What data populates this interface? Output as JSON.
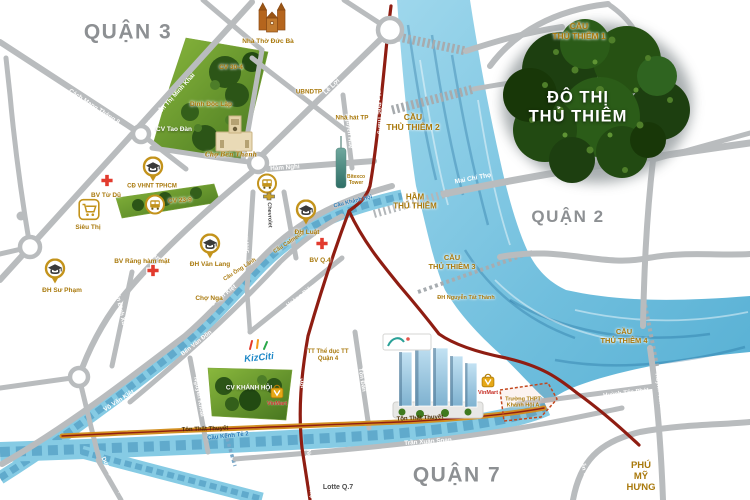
{
  "colors": {
    "road": "#b9bcbe",
    "gold": "#a9790c",
    "blue": "#2577b5",
    "district": "#8d9093",
    "water": "#86cbe4",
    "red-route": "#8f1d12",
    "orange-route": "#d29022",
    "park-green": "#46751f",
    "tree-green": "#224a12",
    "cross-red": "#e23b2e",
    "marker-gold": "#c3931b"
  },
  "map": {
    "districts": [
      {
        "name": "district-label-quan-3",
        "text": "QUẬN 3",
        "x": 128,
        "y": 33,
        "size": 21,
        "cls": "gray"
      },
      {
        "name": "district-label-quan-2",
        "text": "QUẬN 2",
        "x": 568,
        "y": 217,
        "size": 17,
        "cls": "gray"
      },
      {
        "name": "district-label-quan-7",
        "text": "QUẬN 7",
        "x": 457,
        "y": 476,
        "size": 21,
        "cls": "gray"
      },
      {
        "name": "area-label-phu-my-hung",
        "text": "PHÚ\nMỸ\nHƯNG",
        "x": 641,
        "y": 477,
        "size": 9.5,
        "cls": "gold"
      },
      {
        "name": "area-label-do-thi-thu-thiem",
        "text": "ĐÔ THỊ\nTHỦ THIÊM",
        "x": 578,
        "y": 108,
        "size": 16.5,
        "cls": "bigwhite"
      }
    ],
    "bridges": [
      {
        "name": "bridge-label-thu-thiem-1",
        "text": "CẦU\nTHỦ THIÊM 1",
        "x": 579,
        "y": 31,
        "size": 8.5,
        "cls": "gold"
      },
      {
        "name": "bridge-label-thu-thiem-2",
        "text": "CẦU\nTHỦ THIÊM 2",
        "x": 413,
        "y": 122,
        "size": 8.5,
        "cls": "gold"
      },
      {
        "name": "tunnel-label-thu-thiem",
        "text": "HẦM\nTHỦ THIÊM",
        "x": 415,
        "y": 202,
        "size": 8,
        "cls": "gold"
      },
      {
        "name": "bridge-label-thu-thiem-3",
        "text": "CẦU\nTHỦ THIÊM 3",
        "x": 452,
        "y": 263,
        "size": 7.5,
        "cls": "gold"
      },
      {
        "name": "bridge-label-thu-thiem-4",
        "text": "CẦU\nTHỦ THIÊM 4",
        "x": 624,
        "y": 337,
        "size": 7.5,
        "cls": "gold"
      },
      {
        "name": "bridge-label-ong-lanh",
        "text": "Cầu Ông Lãnh",
        "x": 240,
        "y": 270,
        "size": 5.5,
        "rot": -33,
        "cls": "gold"
      },
      {
        "name": "bridge-label-calmette",
        "text": "Cầu Calmette",
        "x": 289,
        "y": 243,
        "size": 5.5,
        "rot": -33,
        "cls": "gold"
      },
      {
        "name": "bridge-label-khanh-hoi",
        "text": "Cầu Khánh Hội",
        "x": 353,
        "y": 202,
        "size": 5.5,
        "rot": -14,
        "cls": "blue"
      },
      {
        "name": "bridge-label-kenh-te-2",
        "text": "Cầu Kênh Tẻ 2",
        "x": 228,
        "y": 437,
        "size": 6,
        "rot": -6,
        "cls": "blue"
      }
    ],
    "roads": [
      {
        "name": "road-label-cach-mang-thang-8",
        "text": "Cách Mạng Tháng 8",
        "x": 94,
        "y": 107,
        "size": 6.3,
        "rot": 33,
        "cls": "onroad"
      },
      {
        "name": "road-label-nguyen-thi-minh-khai-1",
        "text": "Nguyễn Thị Minh Khai",
        "x": 60,
        "y": 204,
        "size": 6.3,
        "rot": -48,
        "cls": "onroad"
      },
      {
        "name": "road-label-nguyen-thi-minh-khai-2",
        "text": "Nguyễn Thị Minh Khai",
        "x": 172,
        "y": 99,
        "size": 6.3,
        "rot": -48,
        "cls": "onroad"
      },
      {
        "name": "road-label-le-loi",
        "text": "Lê Lợi",
        "x": 332,
        "y": 87,
        "size": 6.5,
        "rot": -44,
        "cls": "onroad"
      },
      {
        "name": "road-label-ham-nghi",
        "text": "Hàm Nghi",
        "x": 285,
        "y": 168,
        "size": 6.3,
        "rot": -4,
        "cls": "onroad"
      },
      {
        "name": "road-label-nguyen-hue",
        "text": "Nguyễn Huệ",
        "x": 348,
        "y": 131,
        "size": 6,
        "rot": 84,
        "cls": "onroad"
      },
      {
        "name": "road-label-ton-duc-thang",
        "text": "Tôn Đức Thắng",
        "x": 378,
        "y": 112,
        "size": 6,
        "rot": 87,
        "cls": "onroad"
      },
      {
        "name": "road-label-mai-chi-tho",
        "text": "Mai Chí Thọ",
        "x": 473,
        "y": 179,
        "size": 6.5,
        "rot": -11,
        "cls": "onroad"
      },
      {
        "name": "road-label-nguyen-thai-hoc",
        "text": "Nguyễn Thái Học",
        "x": 243,
        "y": 229,
        "size": 6,
        "rot": 82,
        "cls": "onroad"
      },
      {
        "name": "road-label-tran-hung-dao",
        "text": "Trần Hưng Đạo",
        "x": 157,
        "y": 258,
        "size": 6.3,
        "rot": 40,
        "cls": "onroad"
      },
      {
        "name": "road-label-tran-dinh-xu",
        "text": "Trần Đình Xu",
        "x": 119,
        "y": 307,
        "size": 6,
        "rot": 78,
        "cls": "onroad"
      },
      {
        "name": "road-label-nguyen-van-cu",
        "text": "Nguyễn Văn Cừ",
        "x": 56,
        "y": 316,
        "size": 6,
        "rot": 64,
        "cls": "onroad"
      },
      {
        "name": "road-label-vo-van-kiet-1",
        "text": "Võ Văn Kiệt",
        "x": 222,
        "y": 297,
        "size": 6.3,
        "rot": -38,
        "cls": "onroad"
      },
      {
        "name": "road-label-vo-van-kiet-2",
        "text": "Võ Văn Kiệt",
        "x": 119,
        "y": 401,
        "size": 6.3,
        "rot": -33,
        "cls": "onroad"
      },
      {
        "name": "road-label-ben-van-don",
        "text": "Bến Vân Đồn",
        "x": 197,
        "y": 344,
        "size": 6,
        "rot": -38,
        "cls": "onroad"
      },
      {
        "name": "road-label-nguyen-khoai",
        "text": "Nguyễn Khoái",
        "x": 198,
        "y": 397,
        "size": 6,
        "rot": 80,
        "cls": "onroad"
      },
      {
        "name": "road-label-khanh-hoi",
        "text": "Khánh Hội",
        "x": 297,
        "y": 374,
        "size": 6,
        "rot": 72,
        "cls": "onroad"
      },
      {
        "name": "road-label-ton-dan",
        "text": "Tôn Đản",
        "x": 361,
        "y": 380,
        "size": 6,
        "rot": 81,
        "cls": "onroad"
      },
      {
        "name": "road-label-hoang-dieu",
        "text": "Hoàng Diệu",
        "x": 301,
        "y": 297,
        "size": 6,
        "rot": -37,
        "cls": "onroad"
      },
      {
        "name": "road-label-ton-that-thuyet-1",
        "text": "Tôn Thất Thuyết",
        "x": 205,
        "y": 430,
        "size": 6,
        "rot": -2,
        "cls": "dark"
      },
      {
        "name": "road-label-ton-that-thuyet-2",
        "text": "Tôn Thất Thuyết",
        "x": 420,
        "y": 419,
        "size": 6,
        "rot": -3,
        "cls": "dark"
      },
      {
        "name": "road-label-tran-xuan-soan",
        "text": "Trần Xuân Soạn",
        "x": 428,
        "y": 442,
        "size": 6.3,
        "rot": -4,
        "cls": "onroad"
      },
      {
        "name": "road-label-duong-ba-trac",
        "text": "Dương Bá Trạc",
        "x": 112,
        "y": 477,
        "size": 6,
        "rot": 62,
        "cls": "onroad"
      },
      {
        "name": "road-label-huynh-tan-phat-1",
        "text": "Huỳnh Tấn Phát",
        "x": 626,
        "y": 394,
        "size": 6,
        "rot": -7,
        "cls": "onroad"
      },
      {
        "name": "road-label-huynh-tan-phat-2",
        "text": "Huỳnh Tấn Phát",
        "x": 659,
        "y": 396,
        "size": 6,
        "rot": 82,
        "cls": "onroad"
      },
      {
        "name": "road-label-nguyen-van-linh",
        "text": "Nguyễn Văn Linh",
        "x": 584,
        "y": 473,
        "size": 6,
        "rot": 72,
        "cls": "onroad"
      },
      {
        "name": "road-label-nguyen-huu-tho",
        "text": "Nguyễn Hữu Thọ",
        "x": 309,
        "y": 474,
        "size": 6,
        "rot": 86,
        "cls": "onroad"
      }
    ],
    "pois": [
      {
        "name": "poi-label-cv-30-4",
        "text": "CV 30-4",
        "x": 231,
        "y": 68,
        "size": 6.5,
        "cls": "gold"
      },
      {
        "name": "poi-label-dinh-doc-lap",
        "text": "Dinh Độc Lập",
        "x": 211,
        "y": 105,
        "size": 6.5,
        "cls": "gold"
      },
      {
        "name": "poi-label-cv-tao-dan",
        "text": "CV Tao Đàn",
        "x": 174,
        "y": 130,
        "size": 6.5,
        "cls": "white"
      },
      {
        "name": "poi-label-nha-tho-duc-ba",
        "text": "Nhà Thờ Đức Bà",
        "x": 268,
        "y": 42,
        "size": 6.5,
        "cls": "gold"
      },
      {
        "name": "poi-label-ubndtp",
        "text": "UBNDTP",
        "x": 309,
        "y": 92,
        "size": 6.3,
        "cls": "gold"
      },
      {
        "name": "poi-label-nha-hat-tp",
        "text": "Nhà hát TP",
        "x": 352,
        "y": 118,
        "size": 6.3,
        "cls": "gold"
      },
      {
        "name": "poi-label-bitexco",
        "text": "Bitexco\nTower",
        "x": 356,
        "y": 181,
        "size": 5,
        "cls": "gold"
      },
      {
        "name": "poi-label-cho-ben-thanh",
        "text": "Chợ Bến Thành",
        "x": 231,
        "y": 155,
        "size": 6,
        "cls": "gold script"
      },
      {
        "name": "poi-label-bv-tu-du",
        "text": "BV Từ Dũ",
        "x": 106,
        "y": 196,
        "size": 6.5,
        "cls": "gold"
      },
      {
        "name": "poi-label-cd-vhnt",
        "text": "CĐ VHNT TPHCM",
        "x": 152,
        "y": 187,
        "size": 6,
        "cls": "gold"
      },
      {
        "name": "poi-label-cv-23-9",
        "text": "CV 23-9",
        "x": 180,
        "y": 201,
        "size": 6.5,
        "rot": -4,
        "cls": "gold"
      },
      {
        "name": "poi-label-sieu-thi",
        "text": "Siêu Thị",
        "x": 88,
        "y": 228,
        "size": 6.5,
        "cls": "gold"
      },
      {
        "name": "poi-label-dh-su-pham",
        "text": "ĐH Sư Phạm",
        "x": 62,
        "y": 291,
        "size": 6.5,
        "cls": "gold"
      },
      {
        "name": "poi-label-bv-rang-ham-mat",
        "text": "BV Răng hàm mặt",
        "x": 142,
        "y": 262,
        "size": 6.5,
        "cls": "gold"
      },
      {
        "name": "poi-label-dh-van-lang",
        "text": "ĐH Văn Lang",
        "x": 210,
        "y": 265,
        "size": 6.5,
        "cls": "gold"
      },
      {
        "name": "poi-label-cho-nga",
        "text": "Chợ Nga",
        "x": 209,
        "y": 299,
        "size": 6.5,
        "cls": "gold"
      },
      {
        "name": "poi-label-dh-luat",
        "text": "ĐH Luật",
        "x": 307,
        "y": 233,
        "size": 6.5,
        "cls": "gold"
      },
      {
        "name": "poi-label-bv-q4",
        "text": "BV Q.4",
        "x": 320,
        "y": 261,
        "size": 6.5,
        "cls": "gold"
      },
      {
        "name": "poi-label-chevrolet",
        "text": "Chevrolet",
        "x": 269,
        "y": 215,
        "size": 5.5,
        "rot": 88,
        "cls": "darktext"
      },
      {
        "name": "poi-label-tt-the-duc",
        "text": "TT Thể dục TT\nQuận 4",
        "x": 328,
        "y": 356,
        "size": 6,
        "cls": "gold"
      },
      {
        "name": "poi-label-cv-khanh-hoi",
        "text": "CV KHÁNH HỘI",
        "x": 249,
        "y": 388,
        "size": 6.3,
        "cls": "white"
      },
      {
        "name": "poi-label-kizciti",
        "text": "KizCiti",
        "x": 259,
        "y": 358,
        "size": 9.5,
        "rot": -6,
        "cls": "kizciti"
      },
      {
        "name": "poi-label-vinmart-1",
        "text": "VinMart",
        "x": 277,
        "y": 404,
        "size": 5.5,
        "cls": "red"
      },
      {
        "name": "poi-label-vinmart-2",
        "text": "VinMart",
        "x": 488,
        "y": 393,
        "size": 5.5,
        "cls": "red"
      },
      {
        "name": "poi-label-truong-thpt",
        "text": "Trường THPT\nKhánh Hội A",
        "x": 523,
        "y": 403,
        "size": 5.5,
        "cls": "gold"
      },
      {
        "name": "poi-label-dh-nguyen-tat-thanh",
        "text": "ĐH Nguyễn Tất Thành",
        "x": 466,
        "y": 298,
        "size": 5.5,
        "cls": "gold"
      },
      {
        "name": "poi-label-lotte-q7",
        "text": "Lotte Q.7",
        "x": 338,
        "y": 488,
        "size": 7,
        "cls": "darktext"
      }
    ],
    "markers": [
      {
        "name": "hospital-cross-icon-tu-du",
        "type": "cross",
        "x": 107,
        "y": 183
      },
      {
        "name": "hospital-cross-icon-rang-ham-mat",
        "type": "cross",
        "x": 153,
        "y": 273
      },
      {
        "name": "hospital-cross-icon-bv-q4",
        "type": "cross",
        "x": 322,
        "y": 246
      },
      {
        "name": "university-icon-cd-vhnt",
        "type": "uni",
        "x": 153,
        "y": 172
      },
      {
        "name": "university-icon-dh-su-pham",
        "type": "uni",
        "x": 55,
        "y": 274
      },
      {
        "name": "university-icon-dh-van-lang",
        "type": "uni",
        "x": 210,
        "y": 249
      },
      {
        "name": "university-icon-dh-luat",
        "type": "uni",
        "x": 306,
        "y": 215
      },
      {
        "name": "supermarket-cart-icon",
        "type": "cart",
        "x": 89,
        "y": 212
      },
      {
        "name": "bus-station-icon-1",
        "type": "bus",
        "x": 155,
        "y": 207
      },
      {
        "name": "bus-station-icon-2",
        "type": "bus",
        "x": 267,
        "y": 186
      },
      {
        "name": "vinmart-store-icon-1",
        "type": "vinmart",
        "x": 277,
        "y": 394
      },
      {
        "name": "vinmart-store-icon-2",
        "type": "vinmart",
        "x": 488,
        "y": 383
      },
      {
        "name": "chevrolet-logo-icon",
        "type": "chevy",
        "x": 269,
        "y": 197
      },
      {
        "name": "kizciti-sparks-icon",
        "type": "kiz",
        "x": 259,
        "y": 347
      }
    ]
  }
}
